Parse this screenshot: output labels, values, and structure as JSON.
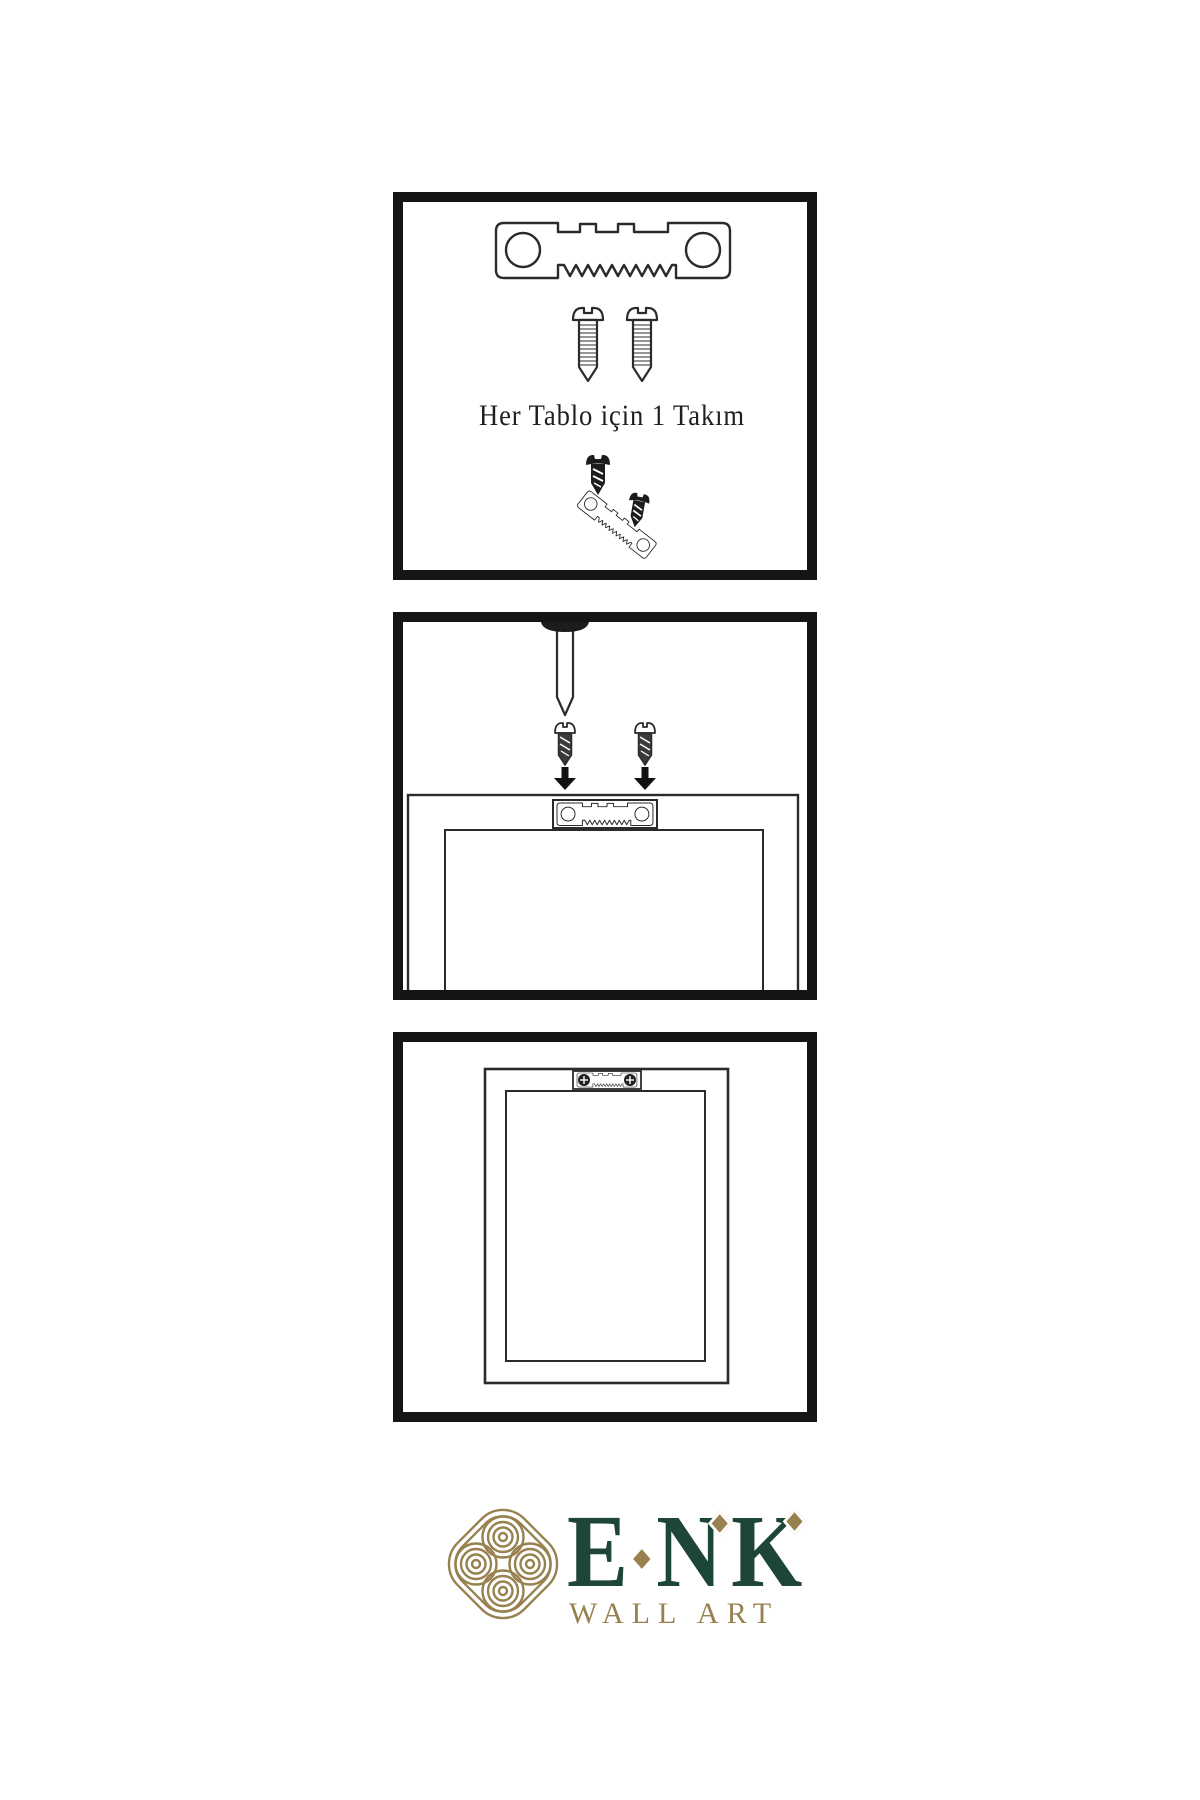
{
  "panel1": {
    "caption": "Her Tablo için 1 Takım"
  },
  "logo": {
    "letters": [
      "E",
      "N",
      "K"
    ],
    "subtitle": "WALL ART"
  },
  "colors": {
    "brand_green": "#1d4636",
    "brand_gold": "#97824f",
    "outline": "#2b2b2b",
    "dark_metal": "#1c1c1c",
    "panel_border": "#151515"
  }
}
